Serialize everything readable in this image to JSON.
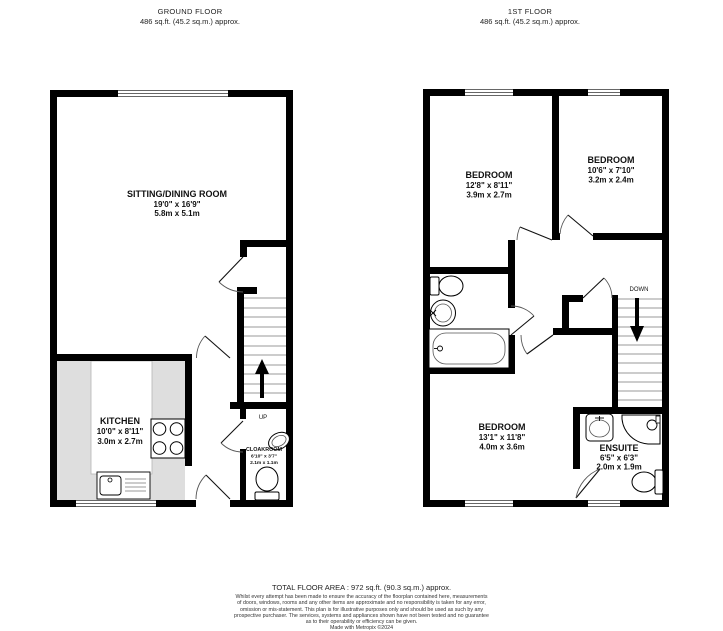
{
  "header": {
    "ground": {
      "title": "GROUND FLOOR",
      "area": "486 sq.ft. (45.2 sq.m.) approx."
    },
    "first": {
      "title": "1ST FLOOR",
      "area": "486 sq.ft. (45.2 sq.m.) approx."
    }
  },
  "ground_floor": {
    "stairs_label": "UP",
    "rooms": {
      "sitting_dining": {
        "name": "SITTING/DINING ROOM",
        "imperial": "19'0\" x 16'9\"",
        "metric": "5.8m x 5.1m"
      },
      "kitchen": {
        "name": "KITCHEN",
        "imperial": "10'0\" x 8'11\"",
        "metric": "3.0m x 2.7m"
      },
      "cloakroom": {
        "name": "CLOAKROOM",
        "imperial": "6'10\" x 3'7\"",
        "metric": "2.1m x 1.1m"
      }
    }
  },
  "first_floor": {
    "stairs_label": "DOWN",
    "rooms": {
      "bedroom_top_left": {
        "name": "BEDROOM",
        "imperial": "12'8\" x 8'11\"",
        "metric": "3.9m x 2.7m"
      },
      "bedroom_top_right": {
        "name": "BEDROOM",
        "imperial": "10'6\" x 7'10\"",
        "metric": "3.2m x 2.4m"
      },
      "bedroom_bottom": {
        "name": "BEDROOM",
        "imperial": "13'1\" x 11'8\"",
        "metric": "4.0m x 3.6m"
      },
      "ensuite": {
        "name": "ENSUITE",
        "imperial": "6'5\" x 6'3\"",
        "metric": "2.0m x 1.9m"
      }
    }
  },
  "footer": {
    "total_area": "TOTAL FLOOR AREA : 972 sq.ft. (90.3 sq.m.) approx.",
    "disclaimer_lines": [
      "Whilst every attempt has been made to ensure the accuracy of the floorplan contained here, measurements",
      "of doors, windows, rooms and any other items are approximate and no responsibility is taken for any error,",
      "omission or mis-statement. This plan is for illustrative purposes only and should be used as such by any",
      "prospective purchaser. The services, systems and appliances shown have not been tested and no guarantee",
      "as to their operability or efficiency can be given."
    ],
    "credit": "Made with Metropix ©2024"
  },
  "colors": {
    "wall": "#000000",
    "kitchen_counter": "#dedede"
  }
}
